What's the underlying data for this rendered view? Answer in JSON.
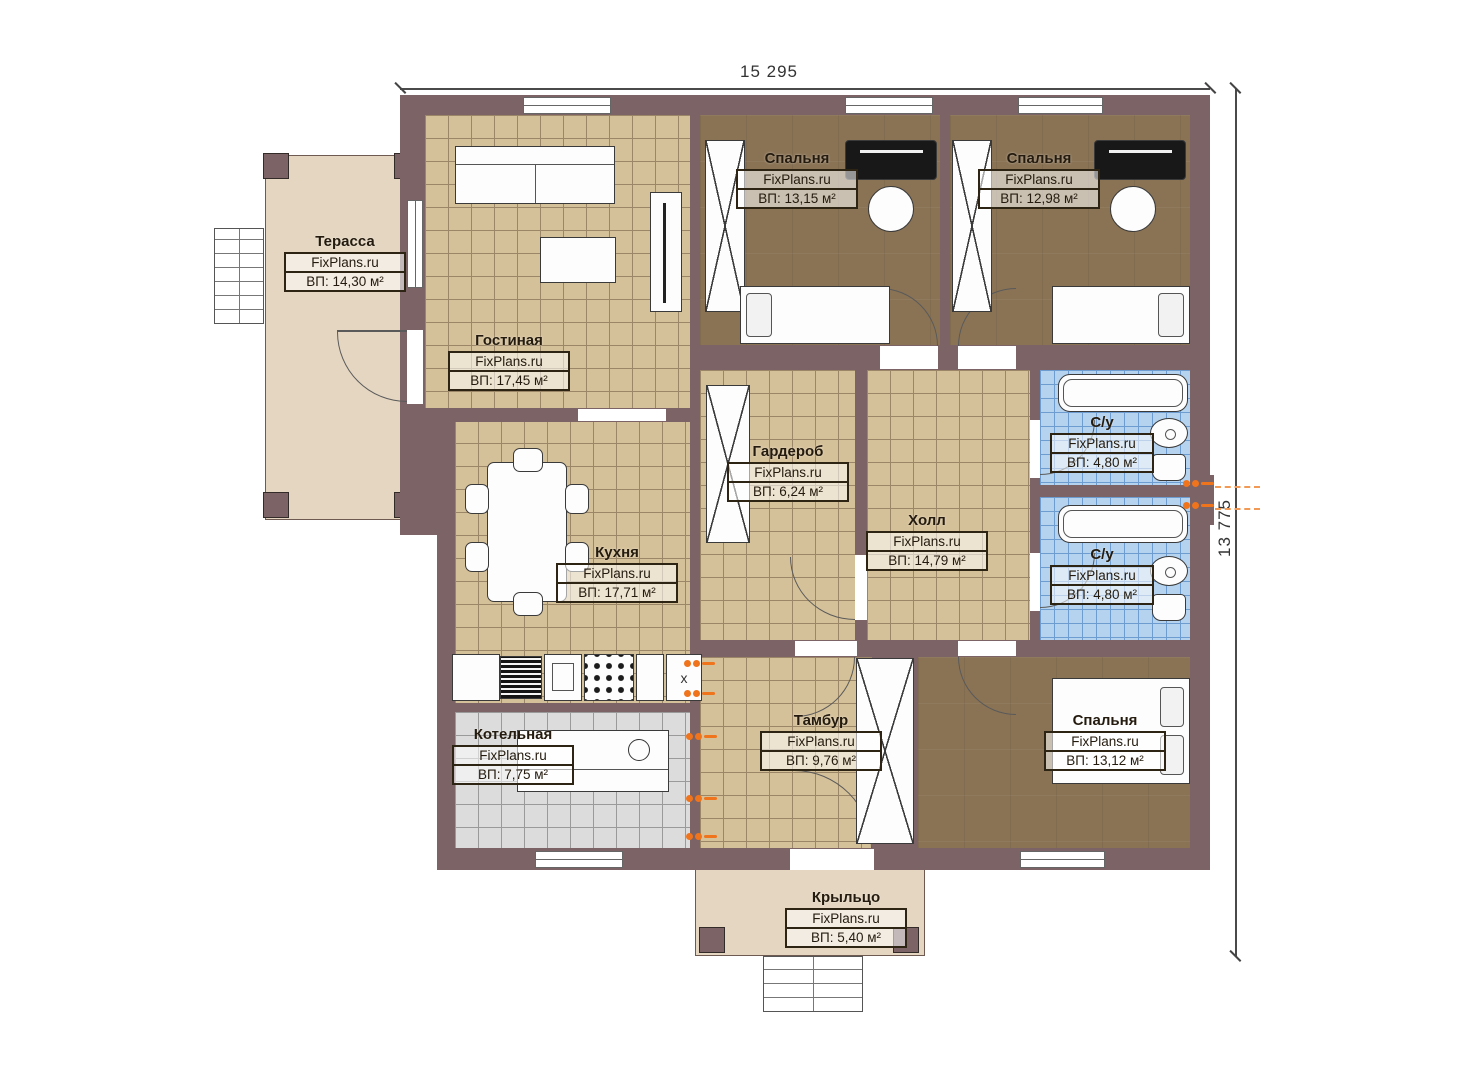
{
  "plan": {
    "watermark": "FixPlans.ru",
    "dimensions": {
      "top": "15 295",
      "right": "13 775"
    },
    "rooms": [
      {
        "id": "terrace",
        "name": "Терасса",
        "area": "ВП: 14,30 м²"
      },
      {
        "id": "living",
        "name": "Гостиная",
        "area": "ВП: 17,45 м²"
      },
      {
        "id": "bedroom1",
        "name": "Спальня",
        "area": "ВП: 13,15 м²"
      },
      {
        "id": "bedroom2",
        "name": "Спальня",
        "area": "ВП: 12,98 м²"
      },
      {
        "id": "wardrobe",
        "name": "Гардероб",
        "area": "ВП: 6,24 м²"
      },
      {
        "id": "hall",
        "name": "Холл",
        "area": "ВП: 14,79 м²"
      },
      {
        "id": "bath1",
        "name": "С/у",
        "area": "ВП: 4,80 м²"
      },
      {
        "id": "bath2",
        "name": "С/у",
        "area": "ВП: 4,80 м²"
      },
      {
        "id": "kitchen",
        "name": "Кухня",
        "area": "ВП: 17,71 м²"
      },
      {
        "id": "boiler",
        "name": "Котельная",
        "area": "ВП: 7,75 м²"
      },
      {
        "id": "vestibule",
        "name": "Тамбур",
        "area": "ВП: 9,76 м²"
      },
      {
        "id": "bedroom3",
        "name": "Спальня",
        "area": "ВП: 13,12 м²"
      },
      {
        "id": "porch",
        "name": "Крыльцо",
        "area": "ВП: 5,40 м²"
      }
    ],
    "colors": {
      "wall": "#7b6366",
      "tile_tan": "#d5c199",
      "floor_bedroom": "#8a7355",
      "tile_bath": "#b5d2ee",
      "tile_boiler": "#dcdcdc",
      "deck_beige": "#e4d6c0",
      "radiator_orange": "#f0741c"
    }
  }
}
